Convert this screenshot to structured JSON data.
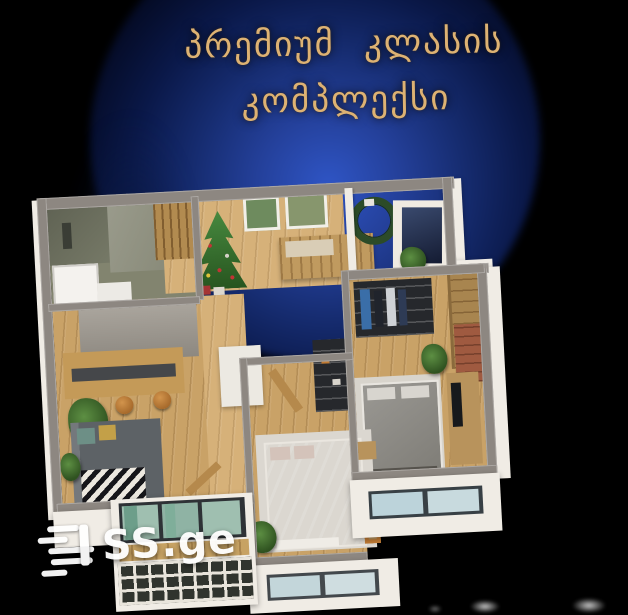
{
  "header": {
    "title_line1": "პრემიუმ კლასის",
    "title_line2": "კომპლექსი",
    "title_color": "#ddb273"
  },
  "watermark": {
    "label": "SS.ge",
    "icon": "speed-lines-icon",
    "color": "#ffffff"
  },
  "scene": {
    "background_color": "#000000",
    "sphere_center_color": "#2f55c5",
    "sphere_edge_color": "#000000"
  },
  "floorplan": {
    "type": "apartment-3d-top-view",
    "wall_top_color": "#8d8781",
    "outer_face_color": "#f0ece5",
    "wood_floor_color": "#c9a267",
    "bathroom_tile_color": "#6d7060",
    "bed1_color": "#c99b93",
    "bed2_color": "#9a9893",
    "sofa_color": "#5d6266",
    "rug_color": "#dbd7d0",
    "balcony_glass_color": "#9fbfb0",
    "rooms": [
      "bathroom",
      "entry-hall",
      "kitchen-living-room",
      "corridor",
      "bedroom-1",
      "bedroom-2",
      "balcony-left",
      "balcony-right"
    ],
    "furnishings": [
      "christmas-tree",
      "wall-pictures",
      "holiday-wreath",
      "entry-bench",
      "navy-panel",
      "clothes-rack",
      "wardrobe",
      "bar-counter",
      "bar-stools",
      "sofa",
      "zigzag-throw",
      "double-bed-pink",
      "double-bed-gray",
      "tv-console",
      "dark-shelf-rack",
      "open-wood-doors",
      "potted-plants",
      "balcony-windows",
      "lattice-railing"
    ]
  }
}
